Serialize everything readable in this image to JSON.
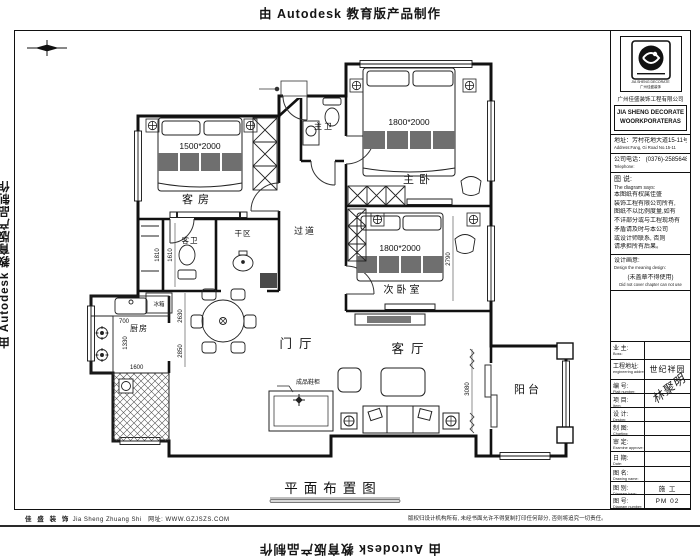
{
  "watermark": {
    "text": "由 Autodesk 教育版产品制作"
  },
  "plan": {
    "title": "平面布置图",
    "rooms": {
      "guest_room": "客房",
      "master_bedroom": "主卧",
      "master_bath": "主卫",
      "second_bedroom": "次卧室",
      "guest_bath": "客卫",
      "dry_area": "干区",
      "corridor": "过道",
      "kitchen": "厨房",
      "foyer": "门厅",
      "living_room": "客厅",
      "balcony": "阳台"
    },
    "furniture_labels": {
      "fridge": "冰箱",
      "shoe_cabinet": "成品鞋柜"
    },
    "bed_sizes": {
      "guest": "1500*2000",
      "master": "1800*2000",
      "second": "1800*2000"
    },
    "dimensions": {
      "d700": "700",
      "d1330": "1330",
      "d1600": "1600",
      "d1610": "1610",
      "d1810": "1810",
      "d2630": "2630",
      "d2850": "2850",
      "d2790": "2790",
      "d3080": "3080"
    }
  },
  "title_block": {
    "logo_caption1": "JIA SHENG DECORATE",
    "logo_caption2": "广州佳盛装饰",
    "company_cn": "广州佳盛装饰工程有限公司",
    "company_en_line1": "JIA SHENG DECORATE",
    "company_en_line2": "WOORKPORATERAS",
    "address_cn": "地址：芳村花地大道15-11号",
    "address_en": "Address:Fang, Gi Road No.15-11",
    "phone_cn": "公司电话： (0376)-2585648",
    "phone_en": "Telephone:",
    "diagram_says_cn": "图 说:",
    "diagram_says_en": "The diagram says:",
    "notice_lines": [
      "本图纸有权属佳盛",
      "装饰工程有限公司所有,",
      "图纸不以比例度量,如有",
      "不详部分或与工程现场有",
      "矛盾请及时与本公司",
      "或设计师联系, 否则",
      "请承担所有后果。"
    ],
    "design_cn": "设计画意:",
    "design_en": "Design the meaning design:",
    "seal_cn": "(未盖章不得使用)",
    "seal_en": "Did not cover chapter can not use",
    "signature": "林聚明",
    "rows": [
      {
        "cn": "业 主:",
        "en": "Boss:",
        "value": ""
      },
      {
        "cn": "工程地址:",
        "en": "engineering address:",
        "value": "世纪祥园"
      },
      {
        "cn": "编 号:",
        "en": "Plait number:",
        "value": ""
      },
      {
        "cn": "项 目:",
        "en": "Item:",
        "value": ""
      },
      {
        "cn": "设 计:",
        "en": "Design:",
        "value": ""
      },
      {
        "cn": "制 图:",
        "en": "Charting:",
        "value": ""
      },
      {
        "cn": "审 定:",
        "en": "Examine approve:",
        "value": ""
      },
      {
        "cn": "日 期:",
        "en": "Date:",
        "value": ""
      },
      {
        "cn": "图 名:",
        "en": "Drawing name:",
        "value": ""
      },
      {
        "cn": "图 别:",
        "en": "Diagram type:",
        "value": "施 工"
      },
      {
        "cn": "图 号:",
        "en": "Diagram number:",
        "value": "PM 02"
      }
    ]
  },
  "footer": {
    "brand_cn": "佳 盛 装 饰",
    "brand_en": "Jia Sheng Zhuang Shi",
    "website": "网址: WWW.GZJSZS.COM",
    "copyright": "版权归设计机构所有, 未经书面允许不得复制打印任何部分, 否则将追究一切责任。"
  }
}
